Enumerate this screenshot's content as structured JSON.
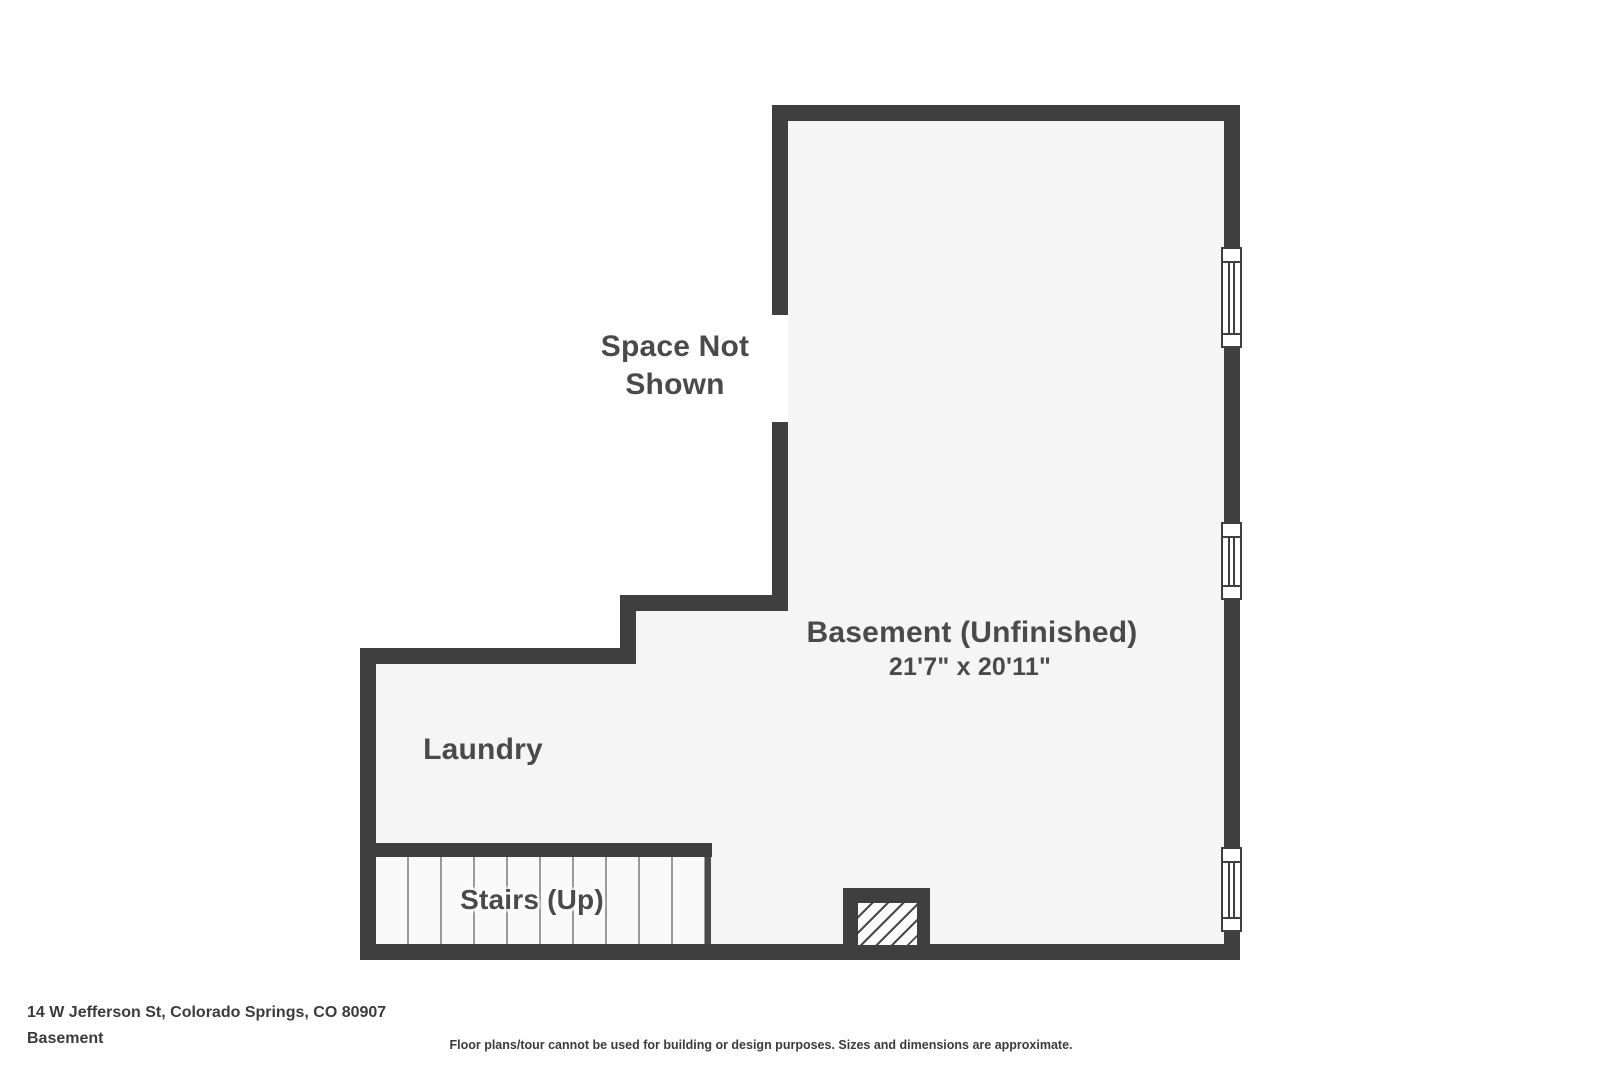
{
  "plan": {
    "labels": {
      "space_not_shown": "Space Not Shown",
      "basement": "Basement (Unfinished)",
      "basement_dims": "21'7\" x 20'11\"",
      "laundry": "Laundry",
      "stairs": "Stairs (Up)"
    }
  },
  "footer": {
    "address": "14 W Jefferson St, Colorado Springs, CO 80907",
    "floor_name": "Basement",
    "disclaimer": "Floor plans/tour cannot be used for building or design purposes. Sizes and dimensions are approximate."
  },
  "colors": {
    "wall": "#3f3f3f",
    "floor": "#f5f5f5",
    "label_text": "#4a4a4a",
    "stair_tread_line": "#9a9a9a",
    "background": "#ffffff"
  }
}
